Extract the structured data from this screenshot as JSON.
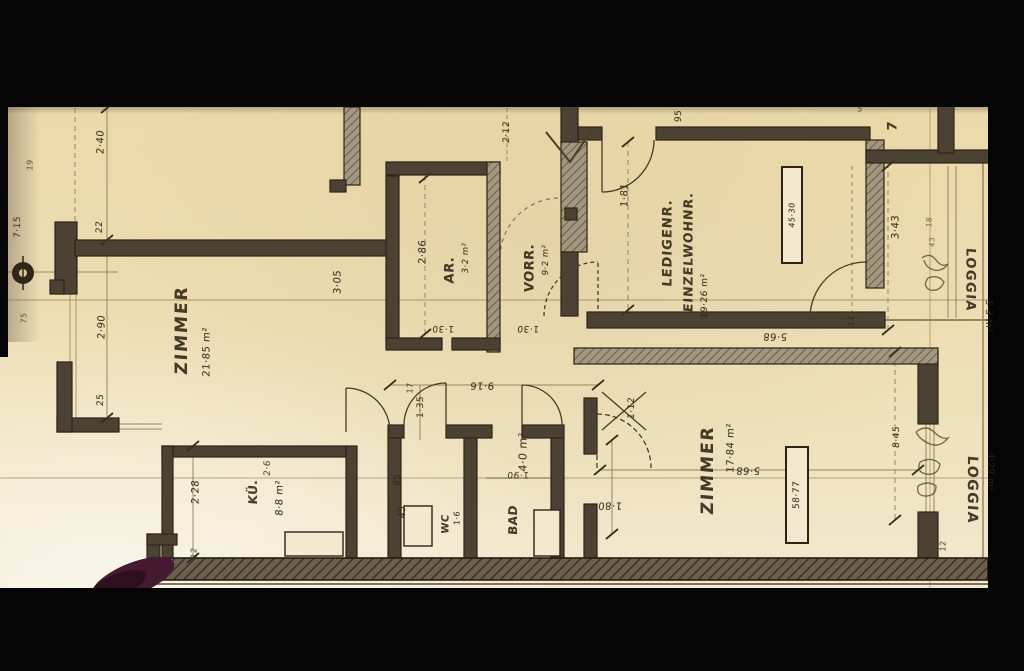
{
  "document": {
    "type": "scanned architectural floor plan (Austrian apartment plan, handwritten German labels)",
    "paper_color": "#edddb2",
    "ink_color": "#2f2517",
    "background_color": "#050505",
    "smudge_color": "#451a30"
  },
  "rooms": {
    "zimmer_upper": {
      "name": "ZIMMER",
      "area": "21·85 m²"
    },
    "abstellraum": {
      "name": "AR.",
      "area": "3·2 m²"
    },
    "vorraum": {
      "name": "VORR.",
      "area": "9·2 m²"
    },
    "einzelwohnraum": {
      "name": "LEDIGENR.",
      "name2": "EINZELWOHNR.",
      "area": "19·26 m²"
    },
    "kueche": {
      "name": "KÜ.",
      "area": "8·8 m²",
      "extra": "2·6"
    },
    "wc": {
      "name": "WC",
      "area": "1·6"
    },
    "bad": {
      "name": "BAD",
      "area": "4·0 m²"
    },
    "zimmer_lower": {
      "name": "ZIMMER",
      "area": "17·84 m²"
    },
    "loggia_upper": {
      "name": "LOGGIA",
      "area": "5·3 m²"
    },
    "loggia_lower": {
      "name": "LOGGIA",
      "area": "4·29 m²"
    }
  },
  "fixtures": {
    "cabinet_upper": {
      "label": "45·30"
    },
    "cabinet_lower": {
      "label": "58·77"
    }
  },
  "dims": {
    "v240": "2·40",
    "v22": "22",
    "v290": "2·90",
    "v25": "25",
    "v715": "7·15",
    "v19": "19",
    "v75": "75",
    "v305": "3·05",
    "v286": "2·86",
    "v130a": "1·30",
    "v130b": "1·30",
    "v212": "2·12",
    "v181": "1·81",
    "v95top": "95",
    "v5": "5",
    "v7": "7",
    "v343": "3·43",
    "v12a": "12",
    "v568a": "5·68",
    "v568b": "5·68",
    "v845": "8·45",
    "v12b": "12",
    "v916": "9·16",
    "v112": "1·12",
    "v180": "1·80",
    "v228": "2·28",
    "v12c": "12",
    "v135": "1·35",
    "v17": "17",
    "v95wc": "95",
    "v45": "45",
    "v190": "1·90",
    "v18": "18",
    "v43": "43"
  }
}
